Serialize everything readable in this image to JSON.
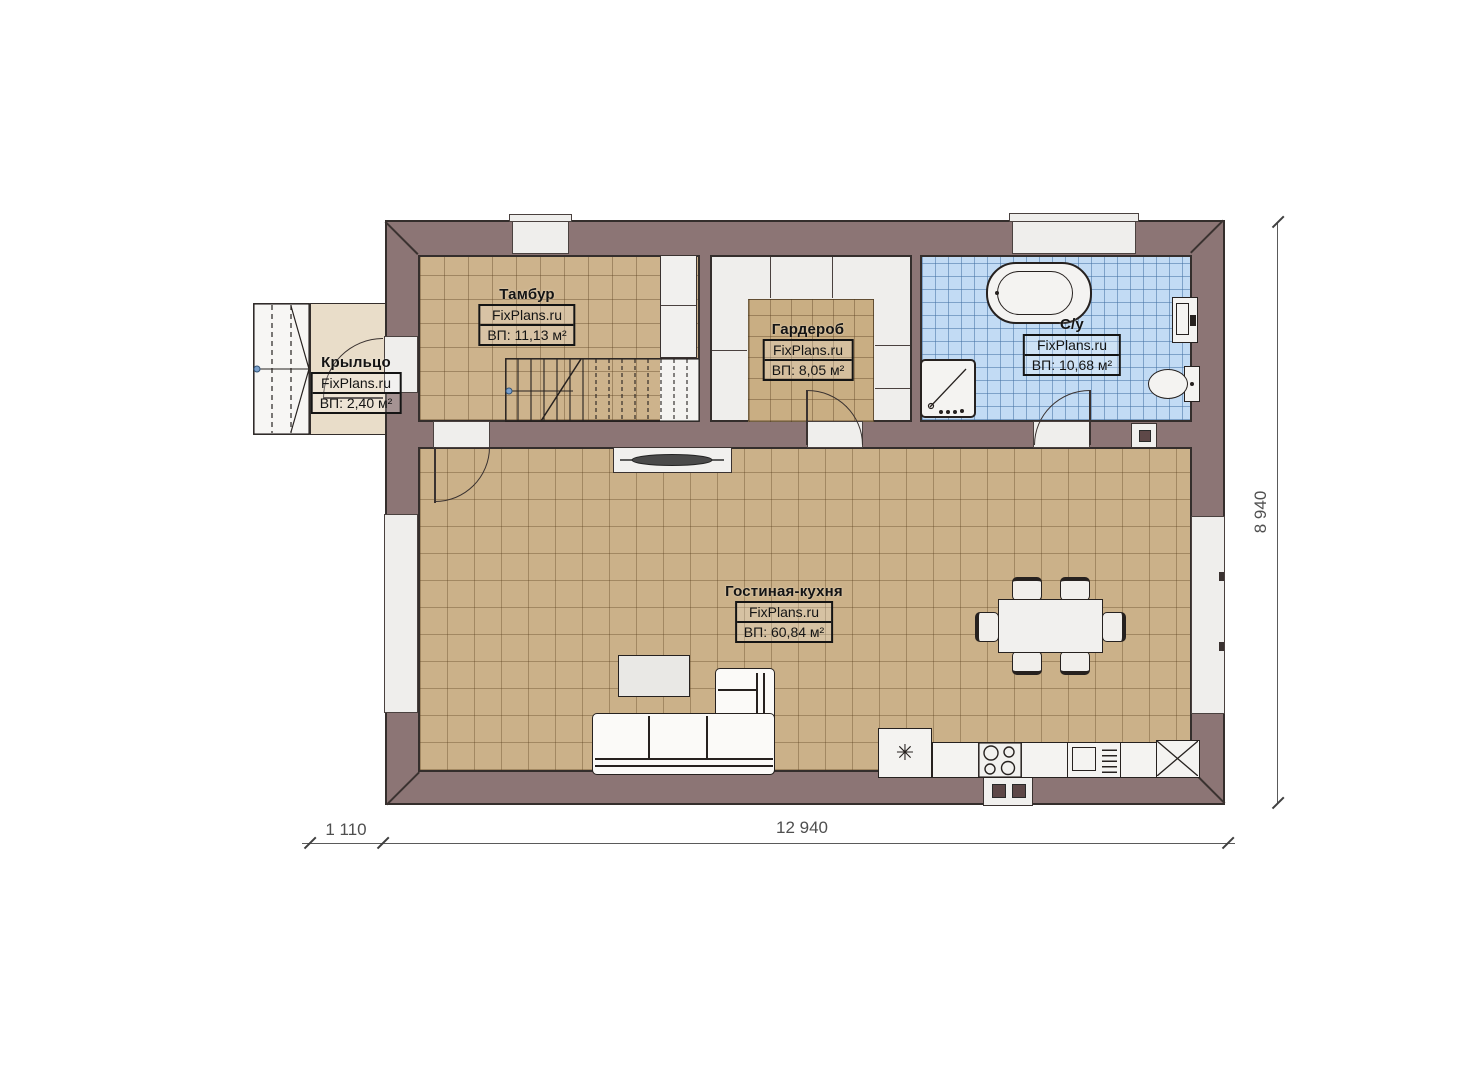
{
  "rooms": [
    {
      "name": "Тамбур",
      "brand": "FixPlans.ru",
      "area": "ВП: 11,13 м²"
    },
    {
      "name": "Гардероб",
      "brand": "FixPlans.ru",
      "area": "ВП: 8,05 м²"
    },
    {
      "name": "С/у",
      "brand": "FixPlans.ru",
      "area": "ВП: 10,68 м²"
    },
    {
      "name": "Крыльцо",
      "brand": "FixPlans.ru",
      "area": "ВП: 2,40 м²"
    },
    {
      "name": "Гостиная-кухня",
      "brand": "FixPlans.ru",
      "area": "ВП: 60,84 м²"
    }
  ],
  "dimensions": {
    "porch_width": "1 110",
    "house_width": "12 940",
    "house_depth": "8 940"
  },
  "symbols": {
    "fridge_snowflake": "✳"
  },
  "colors": {
    "wall": "#8c7575",
    "outline": "#342e2c",
    "floor_tile": "#cbb189",
    "bathroom_tile": "#c2dbf4",
    "porch_floor": "#e9ddc9",
    "fixture_white": "#f2f1ef"
  }
}
